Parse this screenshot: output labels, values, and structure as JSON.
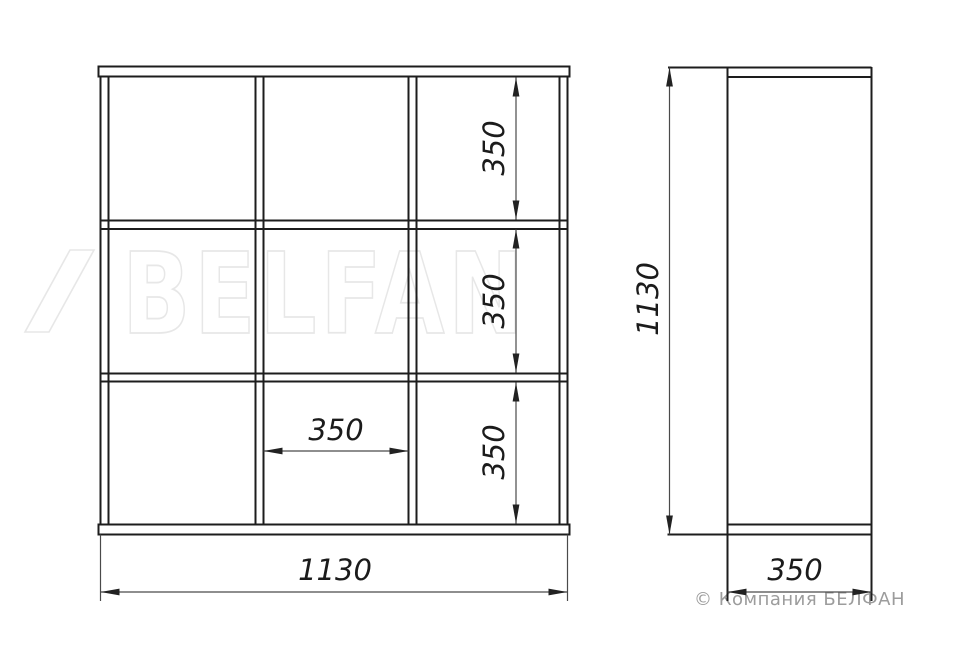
{
  "watermark": {
    "brand": "BELFAN"
  },
  "copyright": "© Компания БЕЛФАН",
  "front_view": {
    "width_label": "1130",
    "cell_width_label": "350",
    "row_height_labels": [
      "350",
      "350",
      "350"
    ]
  },
  "side_view": {
    "height_label": "1130",
    "depth_label": "350"
  },
  "colors": {
    "line": "#1d1d1d",
    "dimension_line": "#4a4a4a",
    "watermark": "#e7e7e7",
    "copyright_text": "#9c9c9c",
    "background": "#ffffff"
  }
}
